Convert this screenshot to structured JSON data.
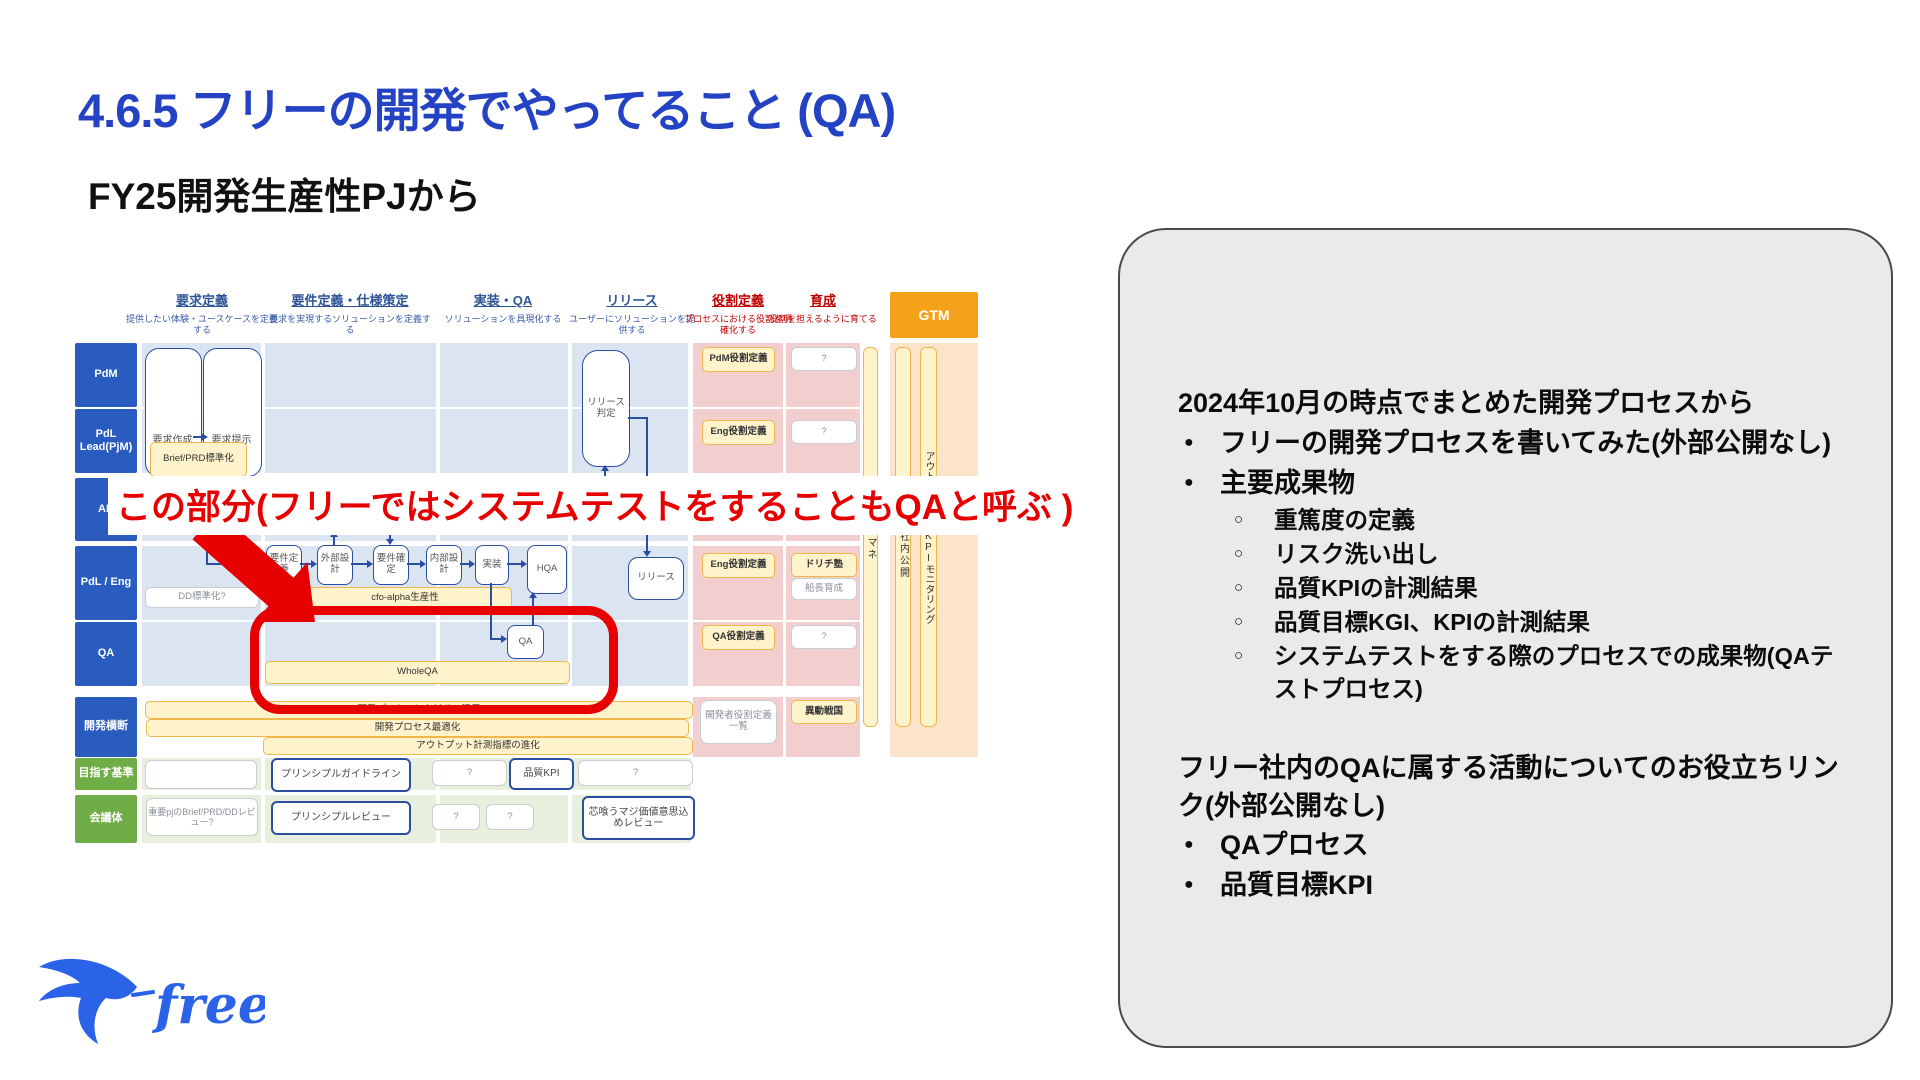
{
  "slide": {
    "title": "4.6.5 フリーの開発でやってること (QA)",
    "subtitle": "FY25開発生産性PJから",
    "annotation": "この部分(フリーではシステムテストをすることもQAと呼ぶ )",
    "logo_text": "freee"
  },
  "colors": {
    "title_blue": "#2443C4",
    "accent_red": "#E60000",
    "row_label_blue": "#2A5CC0",
    "row_label_green": "#6FAE46",
    "gtm_orange": "#F5A21B",
    "panel_bg": "#E9EBEB",
    "cell_blue": "#DBE5F1",
    "cell_pink": "#F2CECE",
    "cell_peach": "#FCE4CB",
    "box_yellow": "#FFF3CC"
  },
  "diagram": {
    "columns": [
      {
        "label": "要求定義",
        "desc": "提供したい体験・ユースケースを定義する"
      },
      {
        "label": "要件定義・仕様策定",
        "desc": "要求を実現するソリューションを定義する"
      },
      {
        "label": "実装・QA",
        "desc": "ソリューションを具現化する"
      },
      {
        "label": "リリース",
        "desc": "ユーザーにソリューションを提供する"
      },
      {
        "label": "役割定義",
        "desc": "プロセスにおける役割を明確化する"
      },
      {
        "label": "育成",
        "desc": "役割を担えるように育てる"
      },
      {
        "label": "GTM"
      }
    ],
    "rows": [
      {
        "label": "PdM"
      },
      {
        "label": "PdL Lead(PjM)"
      },
      {
        "label": "AD"
      },
      {
        "label": "PdL / Eng"
      },
      {
        "label": "QA"
      },
      {
        "label": "開発横断"
      },
      {
        "label": "目指す基準"
      },
      {
        "label": "会議体"
      }
    ],
    "boxes": {
      "yokyu_sakusei": "要求作成",
      "yokyu_teiji": "要求提示",
      "brief_prd": "Brief/PRD標準化",
      "hyojun_ui": "標準UI",
      "yoken_teigi": "要件定義",
      "gaibu_sekkei": "外部設計",
      "yoken_kakutei": "要件確定",
      "naibu_sekkei": "内部設計",
      "jisso": "実装",
      "hqa": "HQA",
      "dd_hyojunka": "DD標準化?",
      "cfo_alpha": "cfo-alpha生産性",
      "release_hantei": "リリース判定",
      "release": "リリース",
      "qa": "QA",
      "whole_qa": "WholeQA",
      "pdm_yakuwari": "PdM役割定義",
      "eng_yakuwari_1": "Eng役割定義",
      "eng_yakuwari_2": "Eng役割定義",
      "qa_yakuwari": "QA役割定義",
      "kaihatsusha_yakuwari": "開発者役割定義一覧",
      "q_pdm": "?",
      "q_pdl": "?",
      "q_qa": "?",
      "dorichi": "ドリチ塾",
      "sencho": "船長育成",
      "ido_sengoku": "異動戦国",
      "naremane": "ナレマネ",
      "map_kokai": "マップ社内公開",
      "outcome_kpi": "アウトカム計測・KPIモニタリング",
      "ai_katsuyo": "開発プロセスにおけるAI活用",
      "process_saiteki": "開発プロセス最適化",
      "output_shihyo": "アウトプット計測指標の進化",
      "principle_guideline": "プリンシプルガイドライン",
      "hinshitsu_kpi": "品質KPI",
      "q_kijun_1": "?",
      "q_kijun_2": "?",
      "juyo_pj": "重要pjのBrief/PRD/DDレビュー?",
      "principle_review": "プリンシプルレビュー",
      "q_kaigi_1": "?",
      "q_kaigi_2": "?",
      "shinkuu": "芯喰うマジ価値意思込めレビュー"
    }
  },
  "panel": {
    "para1": "2024年10月の時点でまとめた開発プロセスから",
    "bullet1": "フリーの開発プロセスを書いてみた(外部公開なし)",
    "bullet2": "主要成果物",
    "sub": [
      "重篤度の定義",
      "リスク洗い出し",
      "品質KPIの計測結果",
      "品質目標KGI、KPIの計測結果",
      "システムテストをする際のプロセスでの成果物(QAテストプロセス)"
    ],
    "para2": "フリー社内のQAに属する活動についてのお役立ちリンク(外部公開なし)",
    "bullet3": "QAプロセス",
    "bullet4": "品質目標KPI"
  }
}
